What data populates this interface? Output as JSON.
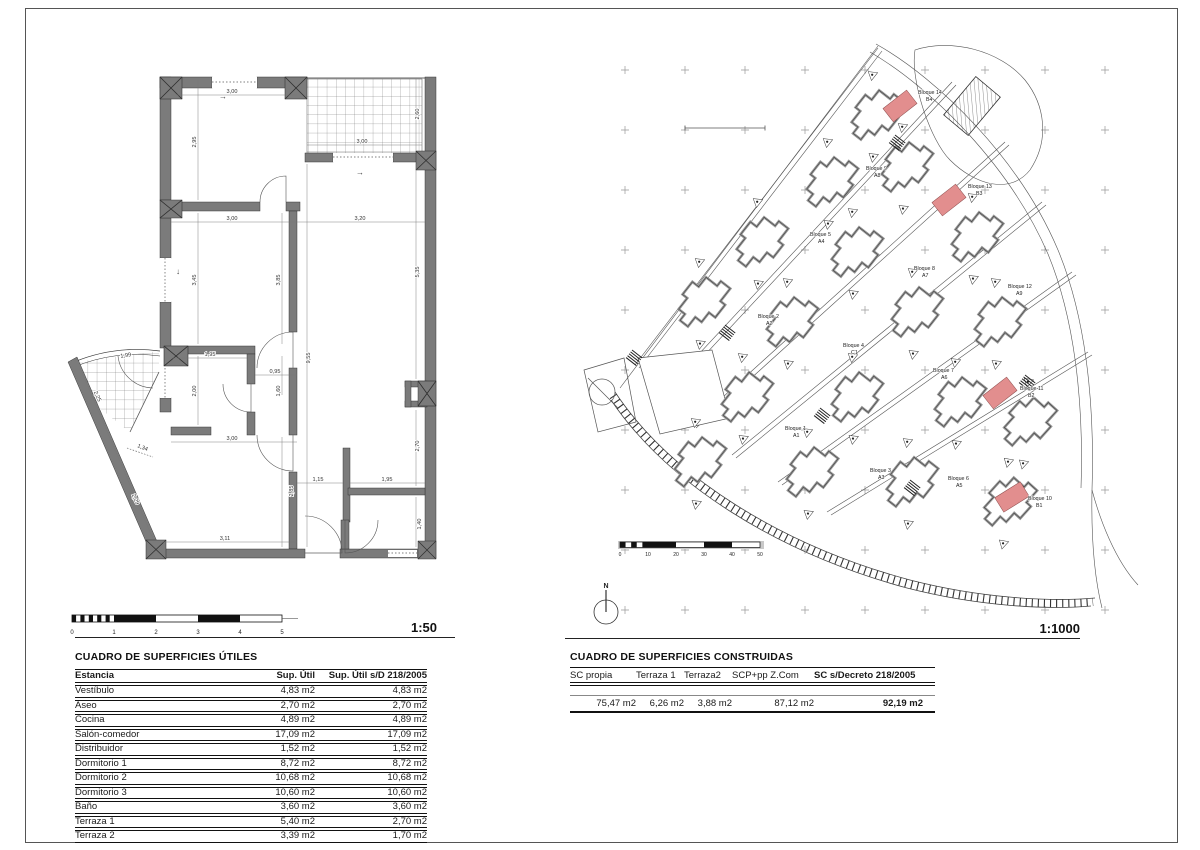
{
  "sheet": {
    "plan_scale": "1:50",
    "site_scale": "1:1000",
    "north": "N"
  },
  "plan": {
    "dims": [
      "3,00",
      "2,60",
      "3,00",
      "2,95",
      "3,00",
      "3,20",
      "3,45",
      "3,85",
      "5,35",
      "9,55",
      "1,95",
      "0,95",
      "2,00",
      "1,60",
      "2,25",
      "1,34",
      "2,29",
      "1,99",
      "3,00",
      "2,85",
      "1,15",
      "1,95",
      "2,70",
      "1,40",
      "3,11"
    ],
    "arrows": [
      "→",
      "→",
      "↓"
    ],
    "scalebar": {
      "ticks": [
        "0",
        "1",
        "2",
        "3",
        "4",
        "5"
      ]
    }
  },
  "site": {
    "highlight_color": "#e28e8e",
    "scalebar": {
      "ticks": [
        "0",
        "10",
        "20",
        "30",
        "40",
        "50"
      ]
    },
    "blocks": [
      {
        "name": "Bloque 1",
        "code": "A1"
      },
      {
        "name": "Bloque 2",
        "code": "A2"
      },
      {
        "name": "Bloque 3",
        "code": "A3"
      },
      {
        "name": "Bloque 4",
        "code": "C1"
      },
      {
        "name": "Bloque 5",
        "code": "A4"
      },
      {
        "name": "Bloque 6",
        "code": "A5"
      },
      {
        "name": "Bloque 7",
        "code": "A6"
      },
      {
        "name": "Bloque 8",
        "code": "A7"
      },
      {
        "name": "Bloque 9",
        "code": "A8"
      },
      {
        "name": "Bloque 10",
        "code": "B1"
      },
      {
        "name": "Bloque 11",
        "code": "B2"
      },
      {
        "name": "Bloque 12",
        "code": "A9"
      },
      {
        "name": "Bloque 13",
        "code": "B3"
      },
      {
        "name": "Bloque 14",
        "code": "B4"
      }
    ]
  },
  "tables": {
    "utiles": {
      "title": "CUADRO DE SUPERFICIES ÚTILES",
      "headers": [
        "Estancia",
        "Sup. Útil",
        "Sup. Útil s/D 218/2005"
      ],
      "rows": [
        [
          "Vestíbulo",
          "4,83 m2",
          "4,83 m2"
        ],
        [
          "Aseo",
          "2,70 m2",
          "2,70 m2"
        ],
        [
          "Cocina",
          "4,89 m2",
          "4,89 m2"
        ],
        [
          "Salón-comedor",
          "17,09 m2",
          "17,09 m2"
        ],
        [
          "Distribuidor",
          "1,52 m2",
          "1,52 m2"
        ],
        [
          "Dormitorio 1",
          "8,72 m2",
          "8,72 m2"
        ],
        [
          "Dormitorio 2",
          "10,68 m2",
          "10,68 m2"
        ],
        [
          "Dormitorio 3",
          "10,60 m2",
          "10,60 m2"
        ],
        [
          "Baño",
          "3,60 m2",
          "3,60 m2"
        ],
        [
          "Terraza 1",
          "5,40 m2",
          "2,70 m2"
        ],
        [
          "Terraza 2",
          "3,39 m2",
          "1,70 m2"
        ]
      ]
    },
    "construidas": {
      "title": "CUADRO DE SUPERFICIES CONSTRUIDAS",
      "headers": [
        "SC propia",
        "Terraza 1",
        "Terraza2",
        "SCP+pp Z.Com",
        "SC s/Decreto 218/2005"
      ],
      "values": [
        "75,47 m2",
        "6,26 m2",
        "3,88 m2",
        "87,12 m2",
        "92,19 m2"
      ]
    }
  }
}
